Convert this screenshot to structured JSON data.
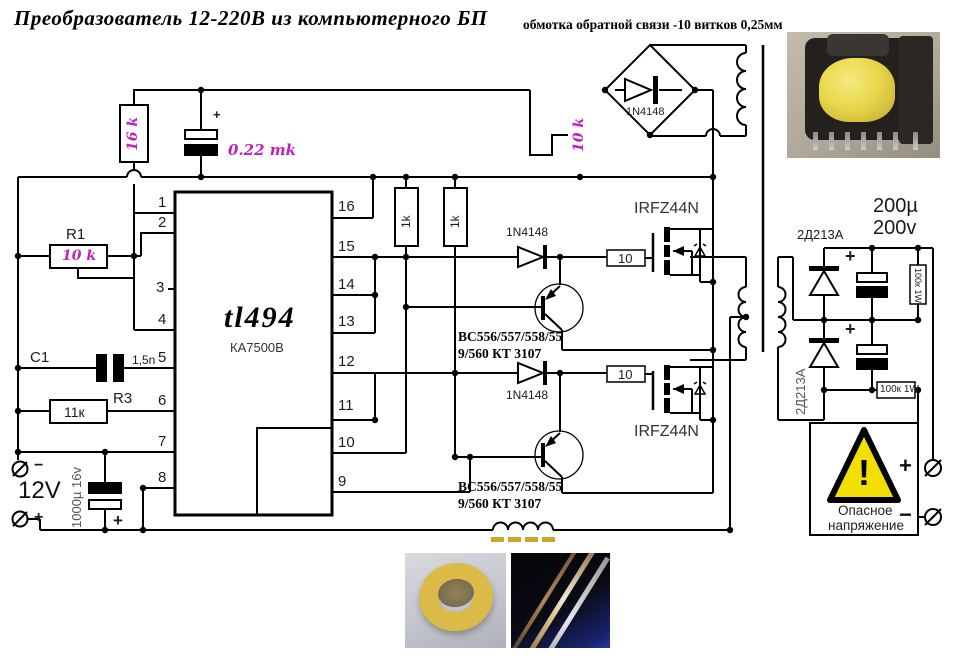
{
  "title": "Преобразователь 12-220В из компьютерного БП",
  "feedback_note": "обмотка обратной связи -10 витков 0,25мм",
  "colors": {
    "magenta": "#c21ec2",
    "warning_yellow": "#f2de00",
    "gold_dash": "#cda42e",
    "wire": "#000000"
  },
  "ic": {
    "name": "tl494",
    "alt": "КА7500В"
  },
  "pins_left": [
    "1",
    "2",
    "3",
    "4",
    "5",
    "6",
    "7",
    "8"
  ],
  "pins_right": [
    "16",
    "15",
    "14",
    "13",
    "12",
    "11",
    "10",
    "9"
  ],
  "components": {
    "r_16k": "16 k",
    "c_022": "0.22 mk",
    "c_022_plus": "+",
    "r_10k_fb": "10 k",
    "bridge_diode": "1N4148",
    "r1_name": "R1",
    "r1_val": "10 k",
    "c1_name": "C1",
    "c1_val": "1,5n",
    "r3_name": "R3",
    "r3_val": "11к",
    "vin_label": "12V",
    "vin_minus": "−",
    "vin_plus": "+",
    "c_in": "1000µ 16v",
    "c_in_plus": "+",
    "r1k_a": "1k",
    "r1k_b": "1k",
    "d_gate1": "1N4148",
    "d_gate2": "1N4148",
    "r_gate1": "10",
    "r_gate2": "10",
    "mosfet1": "IRFZ44N",
    "mosfet2": "IRFZ44N",
    "bjt1_line1": "BC556/557/558/55",
    "bjt1_line2": "9/560 КТ 3107",
    "bjt2_line1": "BC556/557/558/55",
    "bjt2_line2": "9/560 КТ 3107",
    "d_out1": "2Д213А",
    "d_out2": "2Д213А",
    "c_out_line1": "200µ",
    "c_out_line2": "200v",
    "c_out1_plus": "+",
    "c_out2_plus": "+",
    "r_out1": "100к 1W",
    "r_out2": "100к 1W"
  },
  "warning": {
    "line1": "Опасное",
    "line2": "напряжение",
    "mark": "!"
  },
  "output": {
    "plus": "+",
    "minus": "−"
  }
}
